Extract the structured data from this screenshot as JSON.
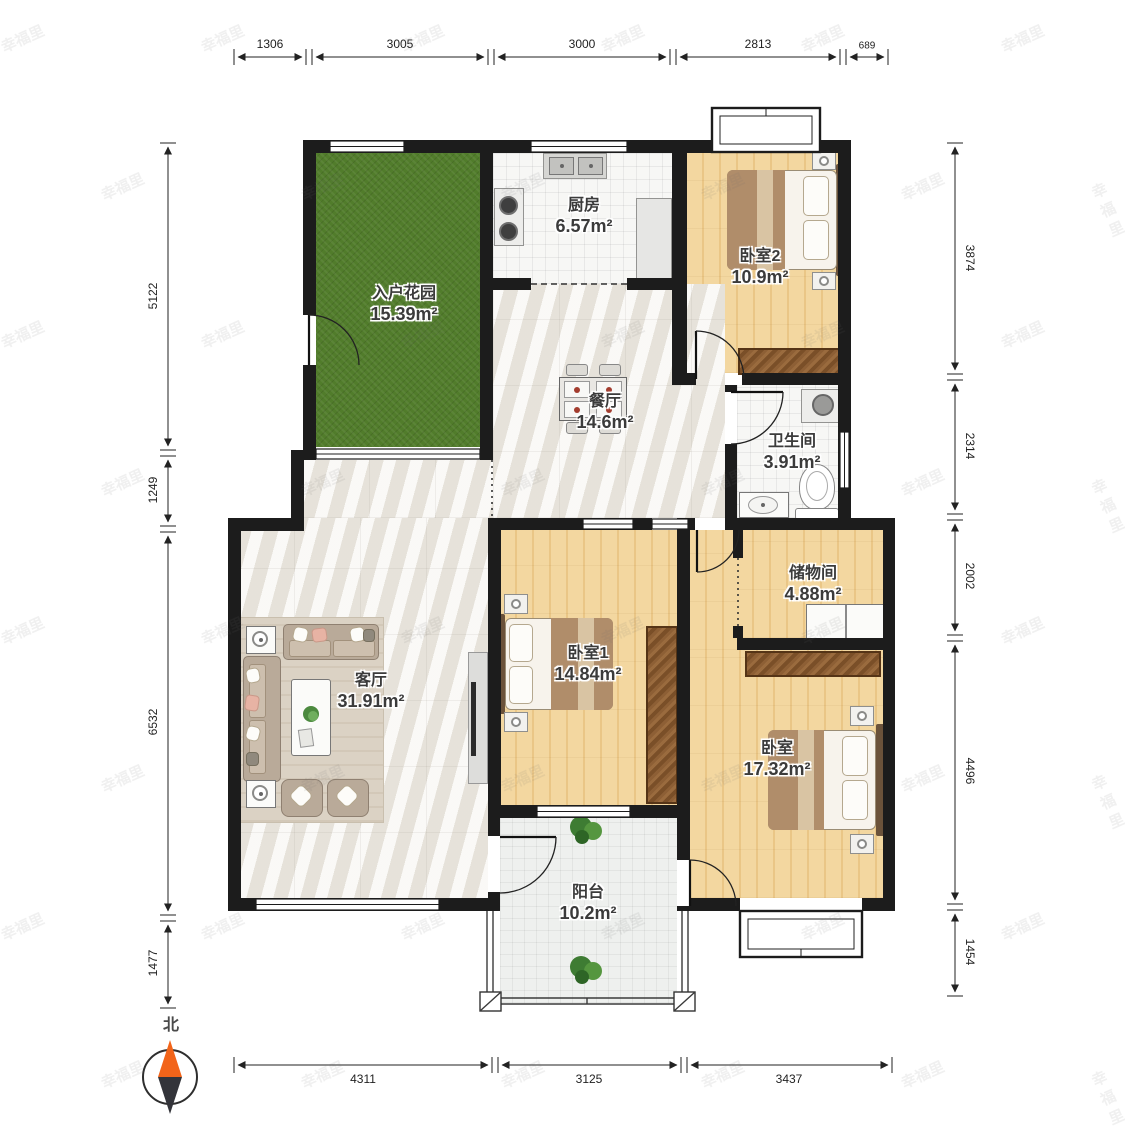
{
  "rooms": {
    "garden": {
      "name": "入户花园",
      "area": "15.39m²"
    },
    "kitchen": {
      "name": "厨房",
      "area": "6.57m²"
    },
    "bedroom2": {
      "name": "卧室2",
      "area": "10.9m²"
    },
    "dining": {
      "name": "餐厅",
      "area": "14.6m²"
    },
    "bathroom": {
      "name": "卫生间",
      "area": "3.91m²"
    },
    "storage": {
      "name": "储物间",
      "area": "4.88m²"
    },
    "living": {
      "name": "客厅",
      "area": "31.91m²"
    },
    "bedroom1": {
      "name": "卧室1",
      "area": "14.84m²"
    },
    "bedroom": {
      "name": "卧室",
      "area": "17.32m²"
    },
    "balcony": {
      "name": "阳台",
      "area": "10.2m²"
    }
  },
  "dimensions": {
    "top": [
      "1306",
      "3005",
      "3000",
      "2813",
      "689"
    ],
    "left": [
      "5122",
      "1249",
      "6532",
      "1477"
    ],
    "right": [
      "3874",
      "2314",
      "2002",
      "4496",
      "1454"
    ],
    "bottom": [
      "4311",
      "3125",
      "3437"
    ]
  },
  "compass": {
    "label": "北"
  },
  "watermark": {
    "text": "幸福里"
  },
  "colors": {
    "wall": "#1c1c1c",
    "grass": "#517c2b",
    "wood": "#f1cf97",
    "marble": "#f0ede7",
    "tile": "#f7f7f5",
    "compass_north": "#f26419",
    "compass_south": "#33343a"
  }
}
